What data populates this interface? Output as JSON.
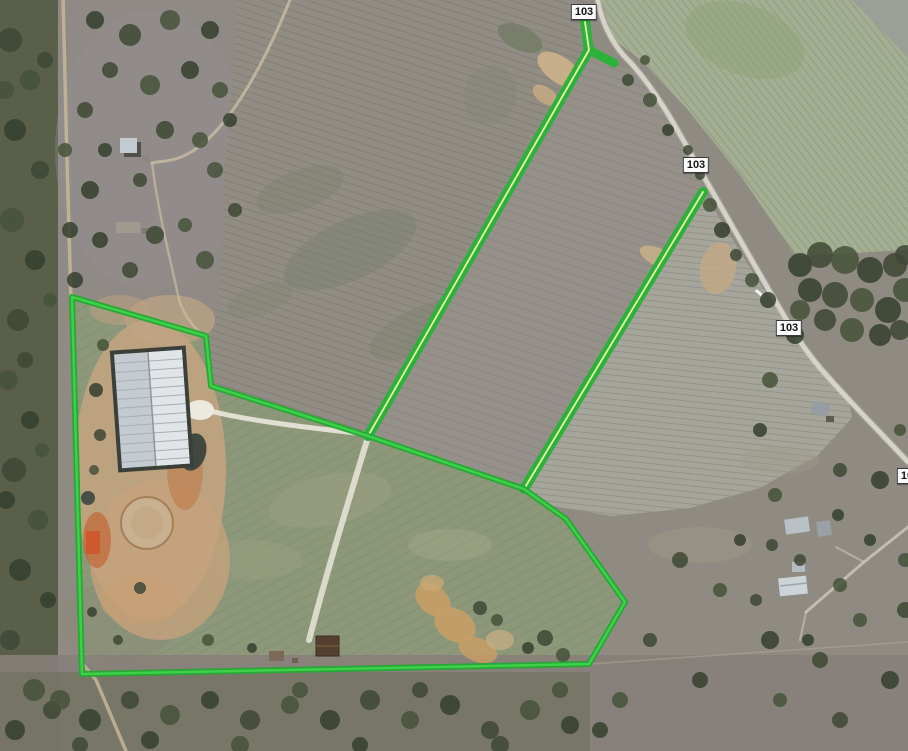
{
  "map": {
    "view_label": "satellite aerial view with parcel overlay",
    "route_markers": [
      {
        "label": "103",
        "x": 584,
        "y": 12
      },
      {
        "label": "103",
        "x": 696,
        "y": 165
      },
      {
        "label": "103",
        "x": 789,
        "y": 328
      },
      {
        "label": "103",
        "x": 910,
        "y": 476
      }
    ],
    "overlay": {
      "boundary_color": "#27a834",
      "boundary_core_color": "#3fd04b",
      "road_line_color": "#2cb13a",
      "centerline_color": "#e9f3a6",
      "parcel_fill_color": "#8d987b",
      "boundary_points": "72,297 206,336 211,386 368,436 524,489 566,519 625,602 589,664 82,674",
      "road_lines": [
        {
          "name": "road-overlay-north",
          "points": "585,22 589,50 368,436"
        },
        {
          "name": "road-overlay-north-branch",
          "points": "589,50 614,63"
        },
        {
          "name": "road-overlay-east",
          "points": "703,192 524,489"
        }
      ]
    }
  }
}
